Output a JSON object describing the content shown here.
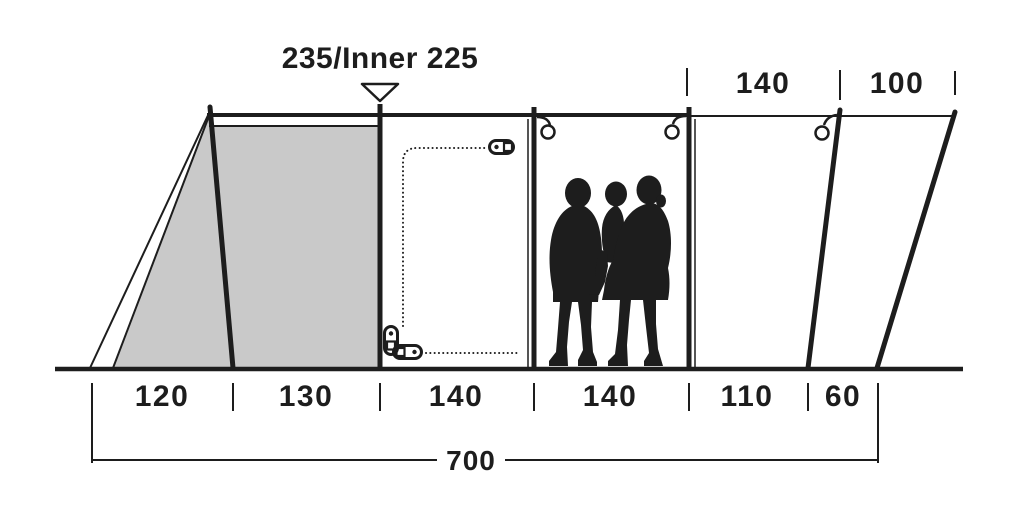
{
  "diagram": {
    "title": "235/Inner 225",
    "top_dims": [
      "140",
      "100"
    ],
    "bottom_dims": [
      "120",
      "130",
      "140",
      "140",
      "110",
      "60"
    ],
    "total": "700"
  },
  "colors": {
    "ink": "#1d1d1d",
    "panel_gray": "#c9c9c9",
    "background": "#ffffff"
  },
  "icons": {
    "marker": "triangle-down-marker",
    "ring": "ring-hook-icon",
    "zipper": "zipper-pull-icon",
    "people": "family-silhouette"
  }
}
